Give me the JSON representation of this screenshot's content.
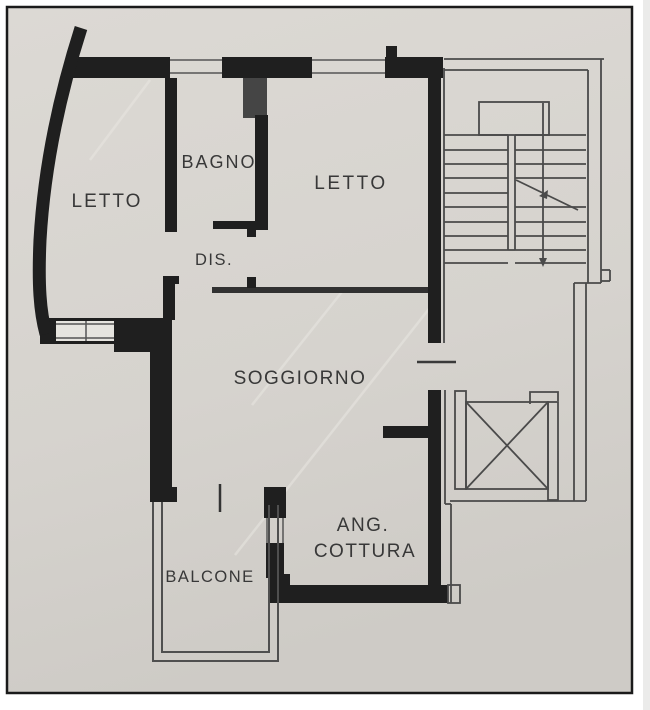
{
  "floorplan": {
    "rooms": {
      "letto_left": "LETTO",
      "bagno": "BAGNO",
      "letto_right": "LETTO",
      "dis": "DIS.",
      "soggiorno": "SOGGIORNO",
      "ang_cottura_line1": "ANG.",
      "ang_cottura_line2": "COTTURA",
      "balcone": "BALCONE"
    },
    "colors": {
      "paper": "#d7d4cf",
      "wall": "#1f1f1f",
      "thin_line": "#4a4a4a",
      "label": "#383838",
      "frame": "#1a1a1a",
      "window_fill": "#e6e4df"
    }
  }
}
